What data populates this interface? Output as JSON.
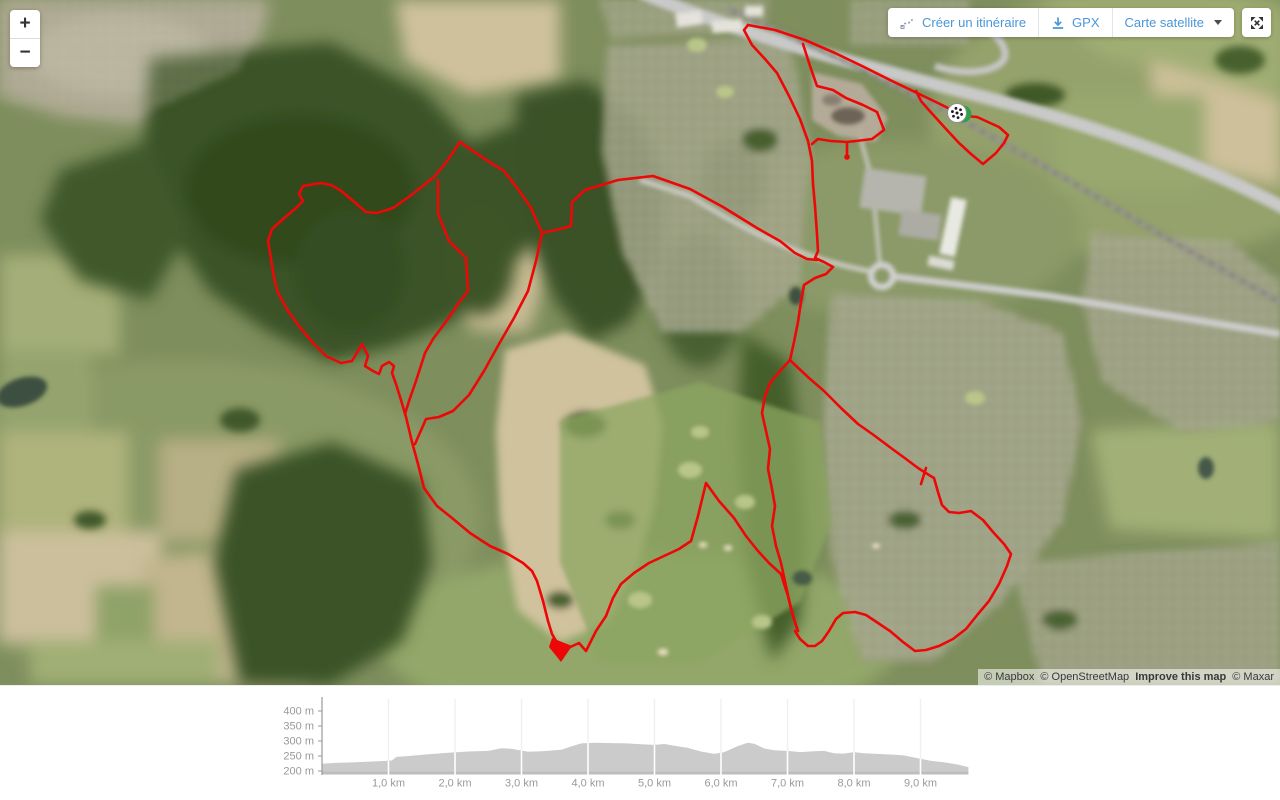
{
  "ui": {
    "accent_color": "#4a96d8",
    "zoom_in": "+",
    "zoom_out": "−",
    "buttons": {
      "create_route": "Créer un itinéraire",
      "gpx": "GPX",
      "layer": "Carte satellite"
    }
  },
  "map": {
    "attribution": {
      "mapbox": "© Mapbox",
      "osm": "© OpenStreetMap",
      "improve": "Improve this map",
      "maxar": "© Maxar"
    },
    "marker": {
      "x": 957,
      "y": 113,
      "flag_color": "#2ca04a"
    },
    "route": {
      "color": "#ed0707",
      "width": 2.6,
      "paths": [
        "M748,25 L775,30 805,40 835,53 862,66 890,80 915,92 940,104 952,110",
        "M748,25 L744,30 752,45 765,59 777,73 789,96 800,119 808,141 812,161 813,184 815,206 817,234 818,251 815,258 824,262 833,267 826,274 815,278 804,285 801,302 798,322 794,342 790,360",
        "M803,44 L810,66 817,86 833,90 846,98 863,105 877,112 884,130 872,139 856,141 847,142 831,141 818,139 812,144",
        "M847,142 L847,156",
        "M916,91 L921,101 927,108 946,129 959,143 971,154 983,164 996,153 1004,143 1008,135 999,127 988,122 977,117 966,116 957,113",
        "M542,233 L560,229 571,226 572,202 585,190 618,180 653,176 690,189 723,207 757,228 780,241 795,253 807,259 817,260",
        "M460,142 L447,161 435,176 424,185 410,196 393,208 377,213 366,212 352,200 340,190 331,185 321,183 303,186 299,194 303,201 295,209 283,219 272,229 268,241 271,259 274,278 278,293 288,311 299,326 313,343 326,356 341,363 352,361 362,344 368,356 365,366 373,371 379,374 382,366 389,362 394,366 392,373 396,384 401,400 406,417 412,442",
        "M460,142 L476,153 491,163 504,171 518,189 531,208 542,233 536,261 528,291 514,318 499,344 484,371 469,395 453,411 439,417 426,419 415,444",
        "M438,180 L438,214 449,241 466,258 468,291 458,304 445,323 433,339 425,353 416,381 409,401 405,414",
        "M412,442 L418,464 424,488 437,506 452,518 470,533 490,546 508,554 523,563 532,571 537,581 543,601 548,621 552,634 556,641",
        "M566,649 L579,643 586,651 596,631 606,616 613,598 621,584 634,573 649,563 664,556 679,549 691,541 698,516 706,483 719,501 734,518 746,536 758,551 769,563 781,574 788,596 793,616 798,631",
        "M790,360 L780,371 770,383 765,396 762,413 766,431 770,449 768,469 772,489 775,506 772,526 776,546 781,563 786,586 791,609 797,629",
        "M790,360 L794,364 809,378 824,391 841,408 858,424 875,436 891,448 906,459 918,468 929,475 934,478 938,492 942,505 949,512 959,513 971,511 983,520 993,532 1004,544 1011,554 1007,566 999,584 989,601 978,614 966,629 953,639 939,646 926,650 915,651 903,642 890,631 878,623 866,615 855,612 843,613 836,619 829,631 822,641 815,646 808,646 800,639 795,631",
        "M926,468 L921,484"
      ],
      "filled": [
        "M552,638 L572,646 561,662 549,647 Z"
      ],
      "dots": [
        [
          847,
          157,
          2.8
        ]
      ]
    }
  },
  "chart_data": {
    "type": "area",
    "title": "",
    "xlabel": "distance (km)",
    "ylabel": "altitude (m)",
    "fill_color": "#cbcbcb",
    "label_color": "#999999",
    "x_max": 9.72,
    "ylim": [
      200,
      440
    ],
    "x_ticks": [
      "1,0 km",
      "2,0 km",
      "3,0 km",
      "4,0 km",
      "5,0 km",
      "6,0 km",
      "7,0 km",
      "8,0 km",
      "9,0 km"
    ],
    "y_ticks": [
      {
        "value": 400,
        "label": "400 m"
      },
      {
        "value": 350,
        "label": "350 m"
      },
      {
        "value": 300,
        "label": "300 m"
      },
      {
        "value": 250,
        "label": "250 m"
      },
      {
        "value": 200,
        "label": "200 m"
      }
    ],
    "plot": {
      "x0": 322,
      "px_per_km": 66.5,
      "y_top": 13,
      "y_base": 85,
      "y_bottom": 88.5,
      "px_per_m": 0.3,
      "base_value": 200
    },
    "profile": [
      [
        0,
        224
      ],
      [
        0.2,
        227
      ],
      [
        0.5,
        229
      ],
      [
        0.8,
        232
      ],
      [
        1.05,
        235
      ],
      [
        1.12,
        247
      ],
      [
        1.3,
        250
      ],
      [
        1.6,
        256
      ],
      [
        1.9,
        261
      ],
      [
        2.2,
        265
      ],
      [
        2.5,
        267
      ],
      [
        2.7,
        276
      ],
      [
        2.85,
        274
      ],
      [
        3.0,
        268
      ],
      [
        3.1,
        264
      ],
      [
        3.3,
        266
      ],
      [
        3.6,
        271
      ],
      [
        3.75,
        282
      ],
      [
        3.9,
        292
      ],
      [
        4.1,
        294
      ],
      [
        4.35,
        293
      ],
      [
        4.6,
        292
      ],
      [
        4.8,
        289
      ],
      [
        5.0,
        287
      ],
      [
        5.15,
        290
      ],
      [
        5.3,
        284
      ],
      [
        5.5,
        277
      ],
      [
        5.7,
        265
      ],
      [
        5.9,
        257
      ],
      [
        6.05,
        263
      ],
      [
        6.25,
        283
      ],
      [
        6.4,
        294
      ],
      [
        6.5,
        291
      ],
      [
        6.65,
        275
      ],
      [
        6.8,
        269
      ],
      [
        7.0,
        267
      ],
      [
        7.2,
        263
      ],
      [
        7.4,
        266
      ],
      [
        7.55,
        267
      ],
      [
        7.7,
        259
      ],
      [
        7.85,
        258
      ],
      [
        8.0,
        263
      ],
      [
        8.15,
        259
      ],
      [
        8.35,
        257
      ],
      [
        8.55,
        255
      ],
      [
        8.75,
        252
      ],
      [
        8.95,
        243
      ],
      [
        9.15,
        234
      ],
      [
        9.35,
        229
      ],
      [
        9.55,
        222
      ],
      [
        9.72,
        213
      ]
    ]
  }
}
